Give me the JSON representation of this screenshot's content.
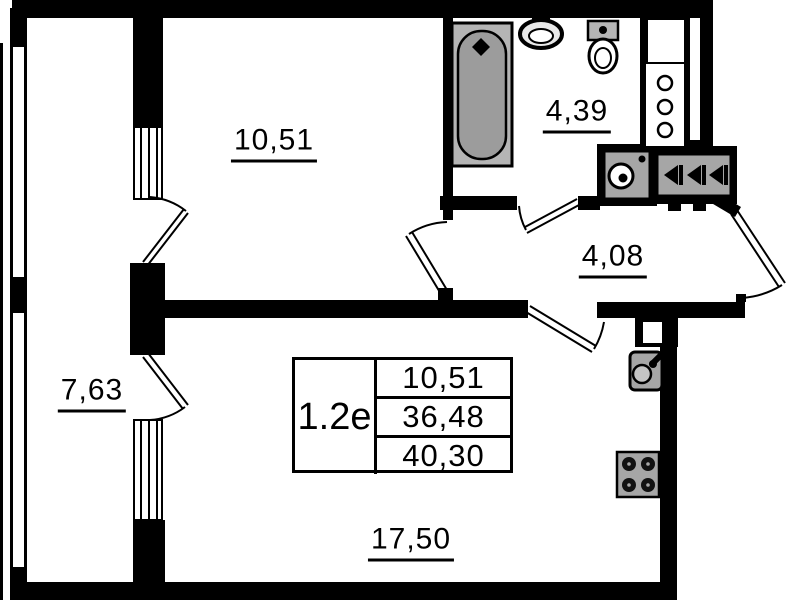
{
  "floorplan": {
    "unit": {
      "label": "1.2е",
      "room_area": "10,51",
      "living_area": "36,48",
      "total_area": "40,30"
    },
    "rooms": {
      "bedroom": {
        "area": "10,51"
      },
      "bathroom": {
        "area": "4,39"
      },
      "hallway": {
        "area": "4,08"
      },
      "balcony": {
        "area": "7,63"
      },
      "living_kitchen": {
        "area": "17,50"
      }
    },
    "fixtures": [
      "bathtub",
      "washbasin",
      "toilet",
      "ventilation-shaft",
      "washing-machine",
      "electrical-panel",
      "entry-door",
      "kitchen-sink",
      "stove",
      "balcony-windows"
    ],
    "colors": {
      "walls": "#000000",
      "fixture_fill": "#a6a6a6",
      "background": "#ffffff"
    }
  }
}
